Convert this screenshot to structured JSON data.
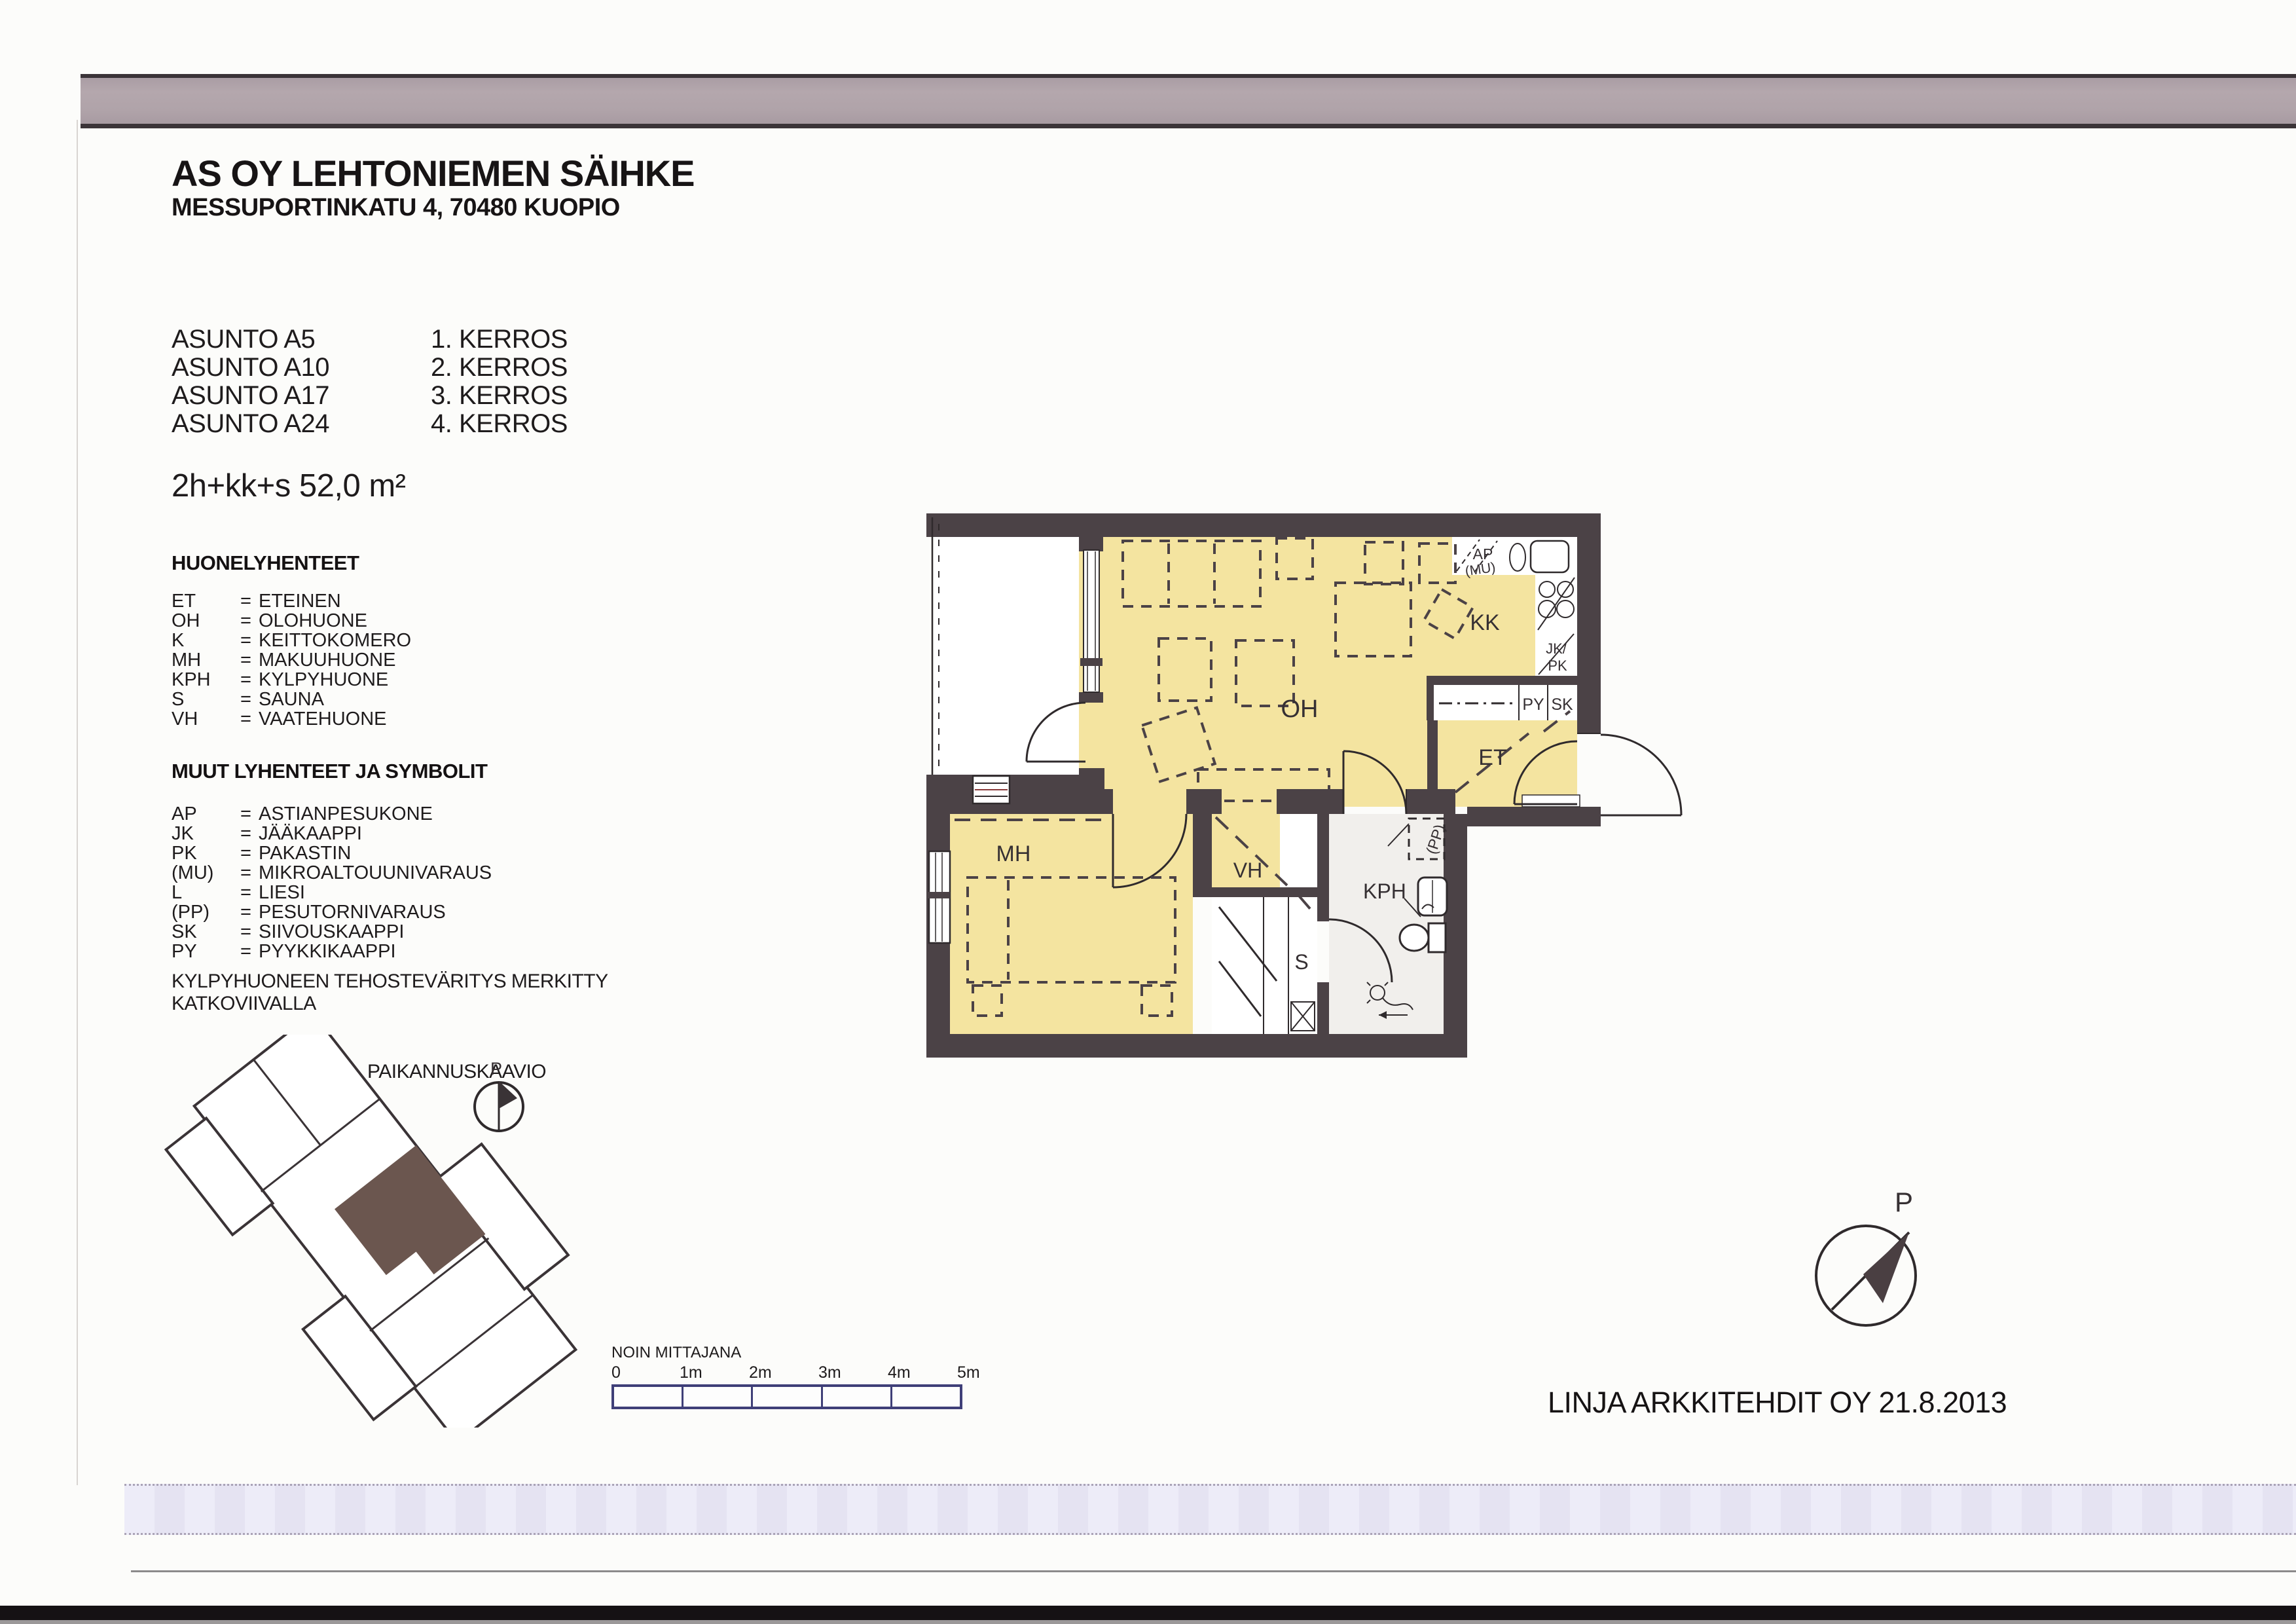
{
  "header": {
    "title": "AS OY LEHTONIEMEN SÄIHKE",
    "address": "MESSUPORTINKATU 4, 70480 KUOPIO"
  },
  "apartments": [
    {
      "unit": "ASUNTO A5",
      "floor": "1. KERROS"
    },
    {
      "unit": "ASUNTO A10",
      "floor": "2. KERROS"
    },
    {
      "unit": "ASUNTO A17",
      "floor": "3. KERROS"
    },
    {
      "unit": "ASUNTO A24",
      "floor": "4. KERROS"
    }
  ],
  "unit_type": "2h+kk+s 52,0 m²",
  "legend_rooms": {
    "heading": "HUONELYHENTEET",
    "equals": "=",
    "items": [
      {
        "abbr": "ET",
        "name": "ETEINEN"
      },
      {
        "abbr": "OH",
        "name": "OLOHUONE"
      },
      {
        "abbr": "K",
        "name": "KEITTOKOMERO"
      },
      {
        "abbr": "MH",
        "name": "MAKUUHUONE"
      },
      {
        "abbr": "KPH",
        "name": "KYLPYHUONE"
      },
      {
        "abbr": "S",
        "name": "SAUNA"
      },
      {
        "abbr": "VH",
        "name": "VAATEHUONE"
      }
    ]
  },
  "legend_symbols": {
    "heading": "MUUT LYHENTEET JA SYMBOLIT",
    "equals": "=",
    "items": [
      {
        "abbr": "AP",
        "name": "ASTIANPESUKONE"
      },
      {
        "abbr": "JK",
        "name": "JÄÄKAAPPI"
      },
      {
        "abbr": "PK",
        "name": "PAKASTIN"
      },
      {
        "abbr": "(MU)",
        "name": "MIKROALTOUUNIVARAUS"
      },
      {
        "abbr": "L",
        "name": "LIESI"
      },
      {
        "abbr": "(PP)",
        "name": "PESUTORNIVARAUS"
      },
      {
        "abbr": "SK",
        "name": "SIIVOUSKAAPPI"
      },
      {
        "abbr": "PY",
        "name": "PYYKKIKAAPPI"
      }
    ]
  },
  "note": {
    "line1": "KYLPYHUONEEN TEHOSTEVÄRITYS MERKITTY",
    "line2": "KATKOVIIVALLA"
  },
  "location_diagram": {
    "heading": "PAIKANNUSKAAVIO",
    "north_label": "P",
    "highlight_color": "#6b564f"
  },
  "plan": {
    "rooms": {
      "oh": "OH",
      "kk": "KK",
      "et": "ET",
      "mh": "MH",
      "vh": "VH",
      "s": "S",
      "kph": "KPH"
    },
    "fixtures": {
      "ap": "AP",
      "mu": "(MU)",
      "jk": "JK/",
      "pk": "PK",
      "py": "PY",
      "sk": "SK",
      "pp": "(PP)"
    },
    "wall_color": "#4b4246",
    "room_fill": "#f4e4a0"
  },
  "scale_bar": {
    "heading": "NOIN MITTAJANA",
    "ticks": [
      "0",
      "1m",
      "2m",
      "3m",
      "4m",
      "5m"
    ],
    "outline_color": "#3f3f78"
  },
  "compass": {
    "north_label": "P"
  },
  "footer": {
    "credit": "LINJA ARKKITEHDIT OY 21.8.2013"
  }
}
